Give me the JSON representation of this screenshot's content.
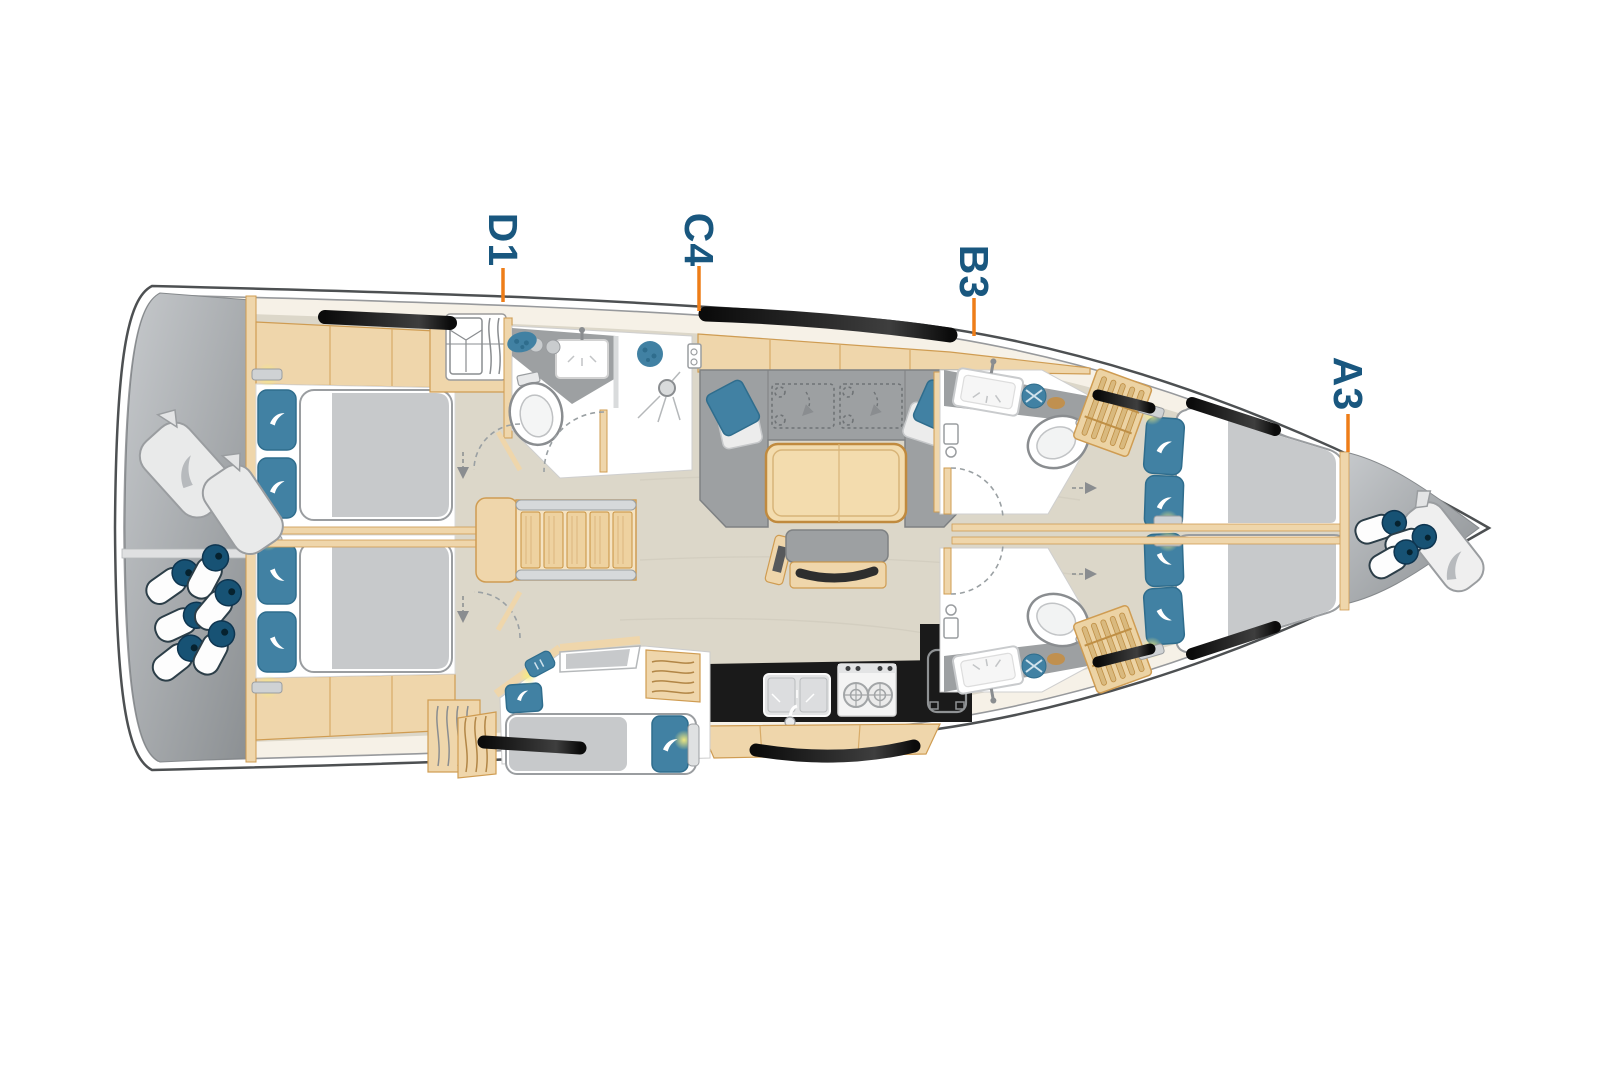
{
  "diagram": {
    "type": "sailing-yacht-deck-layout-plan",
    "cabin_labels": [
      {
        "text": "D1"
      },
      {
        "text": "C4"
      },
      {
        "text": "B3"
      },
      {
        "text": "A3"
      }
    ],
    "colors": {
      "label_text": "#19577f",
      "leader_line": "#ee7d18",
      "hull_outline": "#4d5052",
      "deck_cream": "#f6f1e7",
      "deck_gray": "#a9adb0",
      "interior_floor": "#dcd7c9",
      "woodwork": "#efd6ab",
      "upholstery_gray": "#9da0a2",
      "cushion_blue": "#4181a3",
      "counter_black": "#1a1a1a",
      "fender_navy": "#175274",
      "reading_light_glow": "#f6ec7e"
    },
    "features": [
      "aft-double-cabin-port",
      "aft-double-cabin-starboard",
      "wardrobe",
      "aft-head-with-shower",
      "companionway-stairs",
      "saloon-u-sofa",
      "saloon-table",
      "saloon-bench",
      "galley-sink",
      "galley-stove",
      "galley-fridge",
      "single-berth-cabin",
      "forward-head-port",
      "forward-head-starboard",
      "bow-v-berths",
      "hull-windows",
      "stern-fenders",
      "fender-bags",
      "bow-fenders",
      "sail-bag"
    ]
  }
}
